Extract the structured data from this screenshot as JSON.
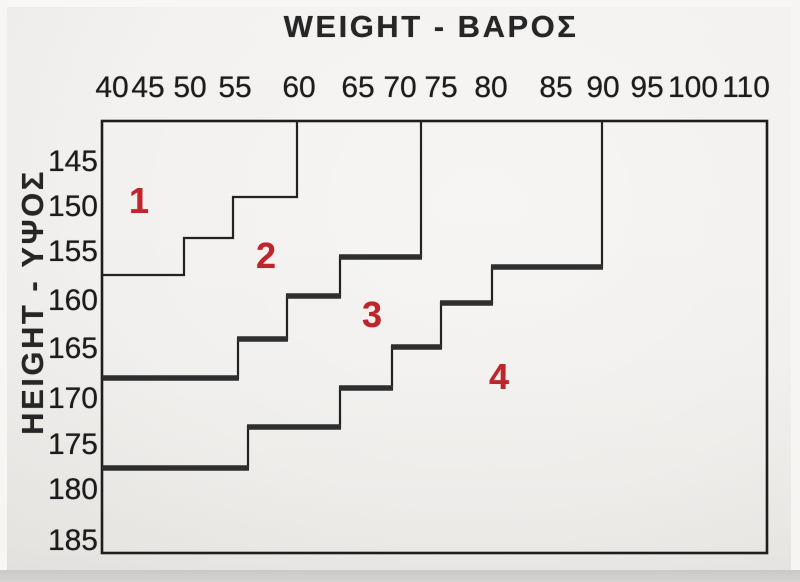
{
  "titles": {
    "x_axis": "WEIGHT - ΒΑΡΟΣ",
    "y_axis": "HEIGHT - ΥΨΟΣ"
  },
  "colors": {
    "background": "#f2f0ee",
    "frame_line": "#1e1e1e",
    "thin_step_line": "#222222",
    "thick_step_line": "#2e2e2e",
    "tick_text": "#1c1c1c",
    "zone_number_red": "#bf252b",
    "bottom_strip": "#d3d2d0"
  },
  "chart_data": {
    "type": "line",
    "subtype": "stepped-size-zone-chart",
    "title": "WEIGHT - ΒΑΡΟΣ",
    "xlabel": "WEIGHT - ΒΑΡΟΣ (kg)",
    "ylabel": "HEIGHT - ΥΨΟΣ (cm)",
    "x_axis_position": "top",
    "y_axis_inverted": true,
    "grid": false,
    "legend": false,
    "x_ticks": [
      40,
      45,
      50,
      55,
      60,
      65,
      70,
      75,
      80,
      85,
      90,
      95,
      100,
      110
    ],
    "y_ticks": [
      145,
      150,
      155,
      160,
      165,
      170,
      175,
      180,
      185
    ],
    "xlim": [
      39,
      114
    ],
    "ylim": [
      140,
      188
    ],
    "zones": [
      {
        "label": "1",
        "position": "upper-left"
      },
      {
        "label": "2",
        "position": "between boundary 1-2 and 2-3"
      },
      {
        "label": "3",
        "position": "between boundary 2-3 and 3-4"
      },
      {
        "label": "4",
        "position": "lower-right"
      }
    ],
    "series": [
      {
        "name": "boundary-size-1-2",
        "line_style": "thin-step",
        "points_weight_height": [
          [
            60,
            140
          ],
          [
            60,
            149
          ],
          [
            55,
            149
          ],
          [
            55,
            153.5
          ],
          [
            50,
            153.5
          ],
          [
            50,
            157.5
          ],
          [
            39,
            157.5
          ]
        ]
      },
      {
        "name": "boundary-size-2-3",
        "line_style": "thick-step",
        "points_weight_height": [
          [
            72.5,
            140
          ],
          [
            72.5,
            155.5
          ],
          [
            63.5,
            155.5
          ],
          [
            63.5,
            159.5
          ],
          [
            59,
            159.5
          ],
          [
            59,
            164
          ],
          [
            55,
            164
          ],
          [
            55,
            168
          ],
          [
            39,
            168
          ]
        ]
      },
      {
        "name": "boundary-size-3-4",
        "line_style": "thick-step",
        "points_weight_height": [
          [
            90,
            140
          ],
          [
            90,
            156.5
          ],
          [
            80,
            156.5
          ],
          [
            80,
            160.5
          ],
          [
            75,
            160.5
          ],
          [
            75,
            165
          ],
          [
            69,
            165
          ],
          [
            69,
            169.5
          ],
          [
            63.5,
            169.5
          ],
          [
            63.5,
            173.5
          ],
          [
            56,
            173.5
          ],
          [
            56,
            178
          ],
          [
            39,
            178
          ]
        ]
      }
    ]
  },
  "layout": {
    "canvas": {
      "width": 800,
      "height": 582
    },
    "frame": {
      "x": 102,
      "y": 121,
      "w": 665,
      "h": 432,
      "stroke_width": 2.6
    },
    "x_title_center": {
      "x": 431,
      "y": 27
    },
    "y_title_center": {
      "x": 33,
      "y": 302
    },
    "x_tick_center_y": 88,
    "y_tick_right_x": 98,
    "x_ticks": [
      {
        "label": "40",
        "x": 112
      },
      {
        "label": "45",
        "x": 148
      },
      {
        "label": "50",
        "x": 190
      },
      {
        "label": "55",
        "x": 235
      },
      {
        "label": "60",
        "x": 299
      },
      {
        "label": "65",
        "x": 358
      },
      {
        "label": "70",
        "x": 400
      },
      {
        "label": "75",
        "x": 441
      },
      {
        "label": "80",
        "x": 491
      },
      {
        "label": "85",
        "x": 556
      },
      {
        "label": "90",
        "x": 603
      },
      {
        "label": "95",
        "x": 647
      },
      {
        "label": "100",
        "x": 693
      },
      {
        "label": "110",
        "x": 746
      }
    ],
    "y_ticks": [
      {
        "label": "145",
        "y": 162
      },
      {
        "label": "150",
        "y": 207
      },
      {
        "label": "155",
        "y": 252
      },
      {
        "label": "160",
        "y": 301
      },
      {
        "label": "165",
        "y": 349
      },
      {
        "label": "170",
        "y": 399
      },
      {
        "label": "175",
        "y": 445
      },
      {
        "label": "180",
        "y": 490
      },
      {
        "label": "185",
        "y": 541
      }
    ],
    "zone_labels": [
      {
        "text": "1",
        "x": 139,
        "y": 201
      },
      {
        "text": "2",
        "x": 266,
        "y": 256
      },
      {
        "text": "3",
        "x": 372,
        "y": 315
      },
      {
        "text": "4",
        "x": 499,
        "y": 377
      }
    ],
    "boundaries": [
      {
        "name": "boundary-size-1-2",
        "thin_width": 2.2,
        "points": [
          [
            297,
            121
          ],
          [
            297,
            197
          ],
          [
            233,
            197
          ],
          [
            233,
            238
          ],
          [
            184,
            238
          ],
          [
            184,
            275
          ],
          [
            103,
            275
          ]
        ],
        "thick_segments": []
      },
      {
        "name": "boundary-size-2-3",
        "thin_width": 2.2,
        "points": [
          [
            421,
            121
          ],
          [
            421,
            257
          ],
          [
            340,
            257
          ],
          [
            340,
            296
          ],
          [
            287,
            296
          ],
          [
            287,
            339
          ],
          [
            238,
            339
          ],
          [
            238,
            378
          ],
          [
            103,
            378
          ]
        ],
        "thick_segments": [
          {
            "x1": 340,
            "x2": 421,
            "y": 257
          },
          {
            "x1": 287,
            "x2": 340,
            "y": 296
          },
          {
            "x1": 238,
            "x2": 287,
            "y": 339
          },
          {
            "x1": 103,
            "x2": 238,
            "y": 378
          }
        ]
      },
      {
        "name": "boundary-size-3-4",
        "thin_width": 2.2,
        "points": [
          [
            602,
            121
          ],
          [
            602,
            267
          ],
          [
            492,
            267
          ],
          [
            492,
            303
          ],
          [
            441,
            303
          ],
          [
            441,
            347
          ],
          [
            392,
            347
          ],
          [
            392,
            388
          ],
          [
            340,
            388
          ],
          [
            340,
            427
          ],
          [
            248,
            427
          ],
          [
            248,
            468
          ],
          [
            103,
            468
          ]
        ],
        "thick_segments": [
          {
            "x1": 492,
            "x2": 602,
            "y": 267
          },
          {
            "x1": 441,
            "x2": 492,
            "y": 303
          },
          {
            "x1": 392,
            "x2": 441,
            "y": 347
          },
          {
            "x1": 340,
            "x2": 392,
            "y": 388
          },
          {
            "x1": 248,
            "x2": 340,
            "y": 427
          },
          {
            "x1": 103,
            "x2": 248,
            "y": 468
          }
        ]
      }
    ],
    "thick_width": 5.5
  }
}
